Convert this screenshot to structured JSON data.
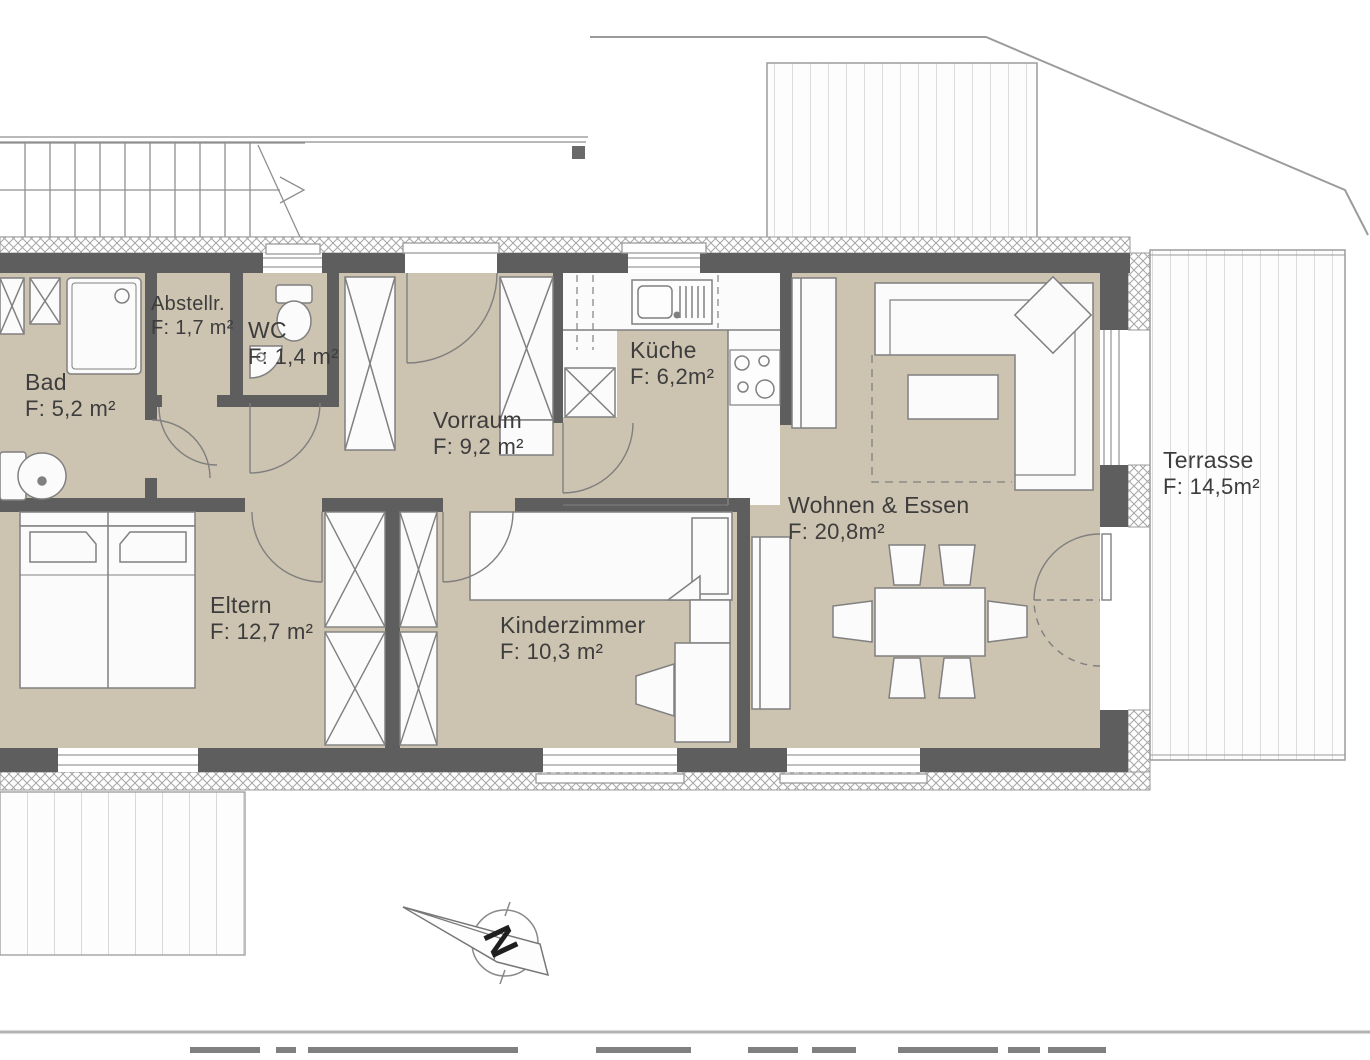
{
  "plan": {
    "type": "apartment-floor-plan",
    "north_label": "N",
    "rooms": [
      {
        "id": "bad",
        "name": "Bad",
        "area": "F: 5,2 m²"
      },
      {
        "id": "abstellraum",
        "name": "Abstellr.",
        "area": "F: 1,7 m²"
      },
      {
        "id": "wc",
        "name": "WC",
        "area": "F: 1,4 m²"
      },
      {
        "id": "vorraum",
        "name": "Vorraum",
        "area": "F: 9,2 m²"
      },
      {
        "id": "kueche",
        "name": "Küche",
        "area": "F: 6,2m²"
      },
      {
        "id": "wohnen-essen",
        "name": "Wohnen & Essen",
        "area": "F: 20,8m²"
      },
      {
        "id": "terrasse",
        "name": "Terrasse",
        "area": "F: 14,5m²"
      },
      {
        "id": "eltern",
        "name": "Eltern",
        "area": "F: 12,7 m²"
      },
      {
        "id": "kinderzimmer",
        "name": "Kinderzimmer",
        "area": "F: 10,3 m²"
      }
    ],
    "colors": {
      "wall": "#5e5e5e",
      "floor": "#cdc3b1",
      "line": "#9b9b9b",
      "text": "#3d3d3d"
    }
  }
}
